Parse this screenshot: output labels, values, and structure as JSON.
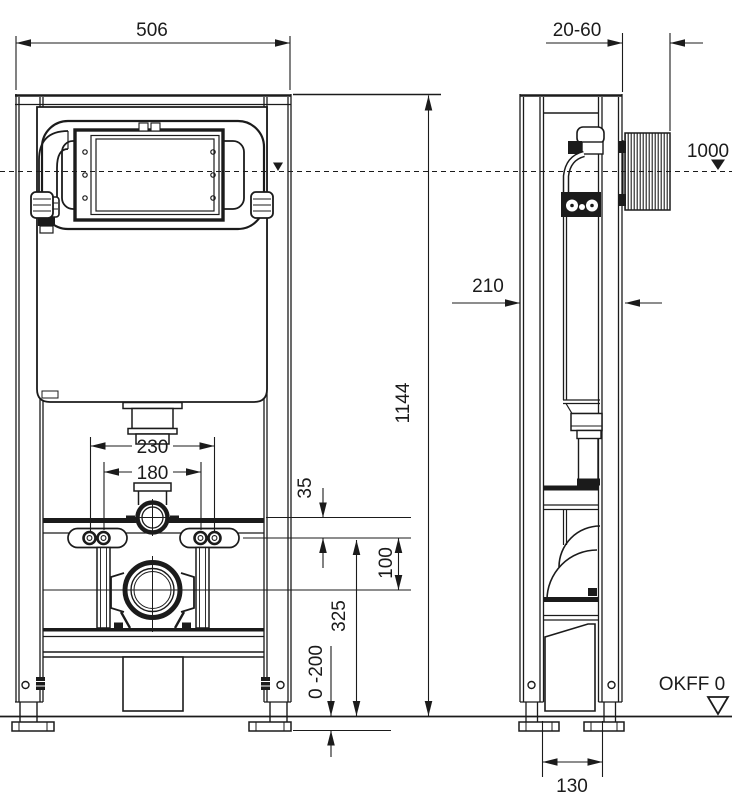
{
  "drawing": {
    "dims": {
      "front_width": "506",
      "wall_gap": "20-60",
      "level_height": "1000",
      "depth": "210",
      "total_height": "1144",
      "pipe_to_bracket": "35",
      "bracket_to_outlet": "100",
      "bracket_height": "325",
      "leg_range": "0 -200",
      "bolt_spacing_outer": "230",
      "bolt_spacing_inner": "180",
      "foot_width": "130"
    },
    "labels": {
      "floor": "OKFF 0"
    }
  }
}
